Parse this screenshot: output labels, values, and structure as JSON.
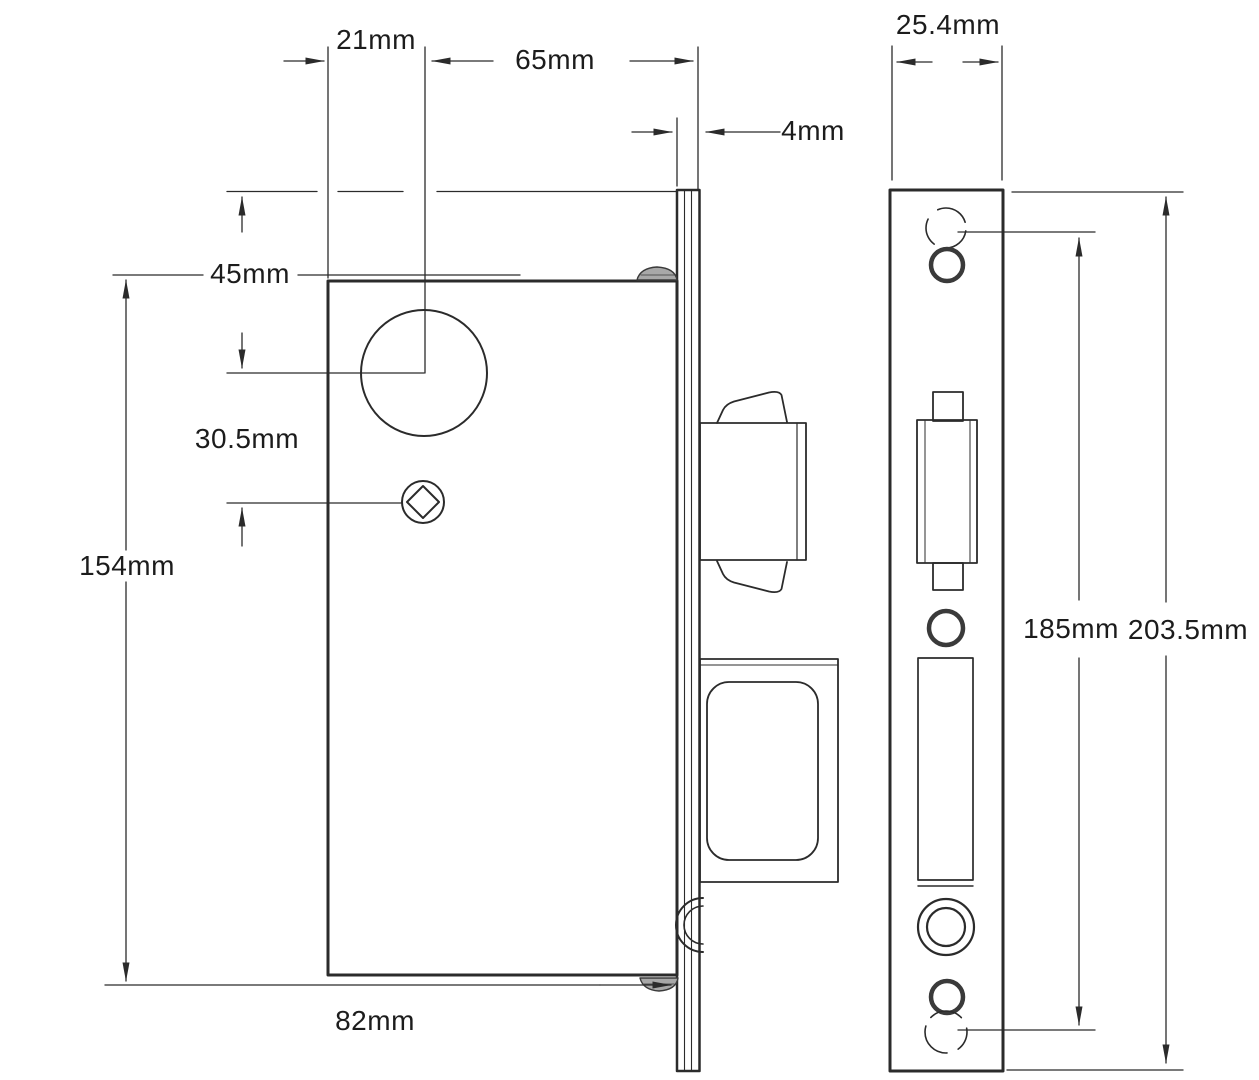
{
  "drawing": {
    "title": "Mortice lock case and faceplate dimension drawing",
    "unit": "mm",
    "line_color": "#2b2b2b",
    "dimensions": {
      "cylinder_offset_from_case_edge": "21mm",
      "backset": "65mm",
      "faceplate_thickness": "4mm",
      "faceplate_width": "25.4mm",
      "top_to_cylinder_centre": "45mm",
      "cylinder_to_spindle_centre": "30.5mm",
      "case_height": "154mm",
      "case_depth": "82mm",
      "fixing_hole_centres": "185mm",
      "faceplate_height": "203.5mm"
    }
  }
}
